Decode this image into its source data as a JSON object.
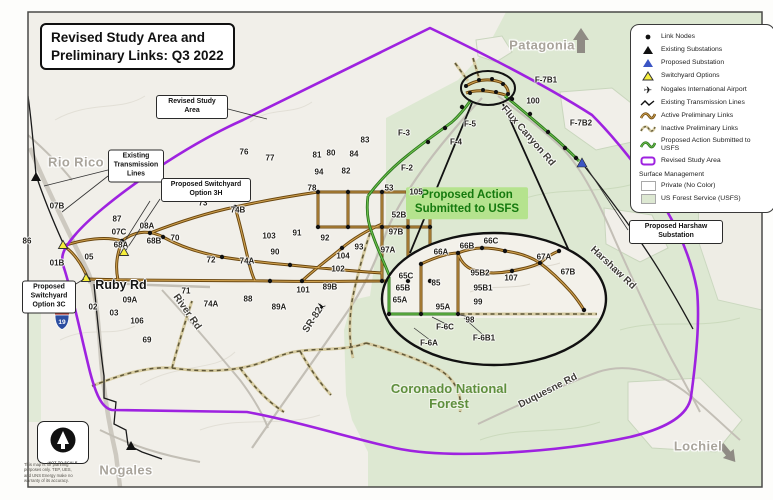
{
  "title": {
    "line1": "Revised Study Area and",
    "line2": "Preliminary Links: Q3 2022"
  },
  "legend": {
    "items": [
      {
        "icon": "link-node",
        "label": "Link Nodes"
      },
      {
        "icon": "existing-substation",
        "label": "Existing Substations"
      },
      {
        "icon": "proposed-substation",
        "label": "Proposed Substation"
      },
      {
        "icon": "switchyard-option",
        "label": "Switchyard Options"
      },
      {
        "icon": "airport",
        "label": "Nogales International Airport"
      },
      {
        "icon": "existing-transmission",
        "label": "Existing Transmission Lines"
      },
      {
        "icon": "active-link",
        "label": "Active Preliminary Links"
      },
      {
        "icon": "inactive-link",
        "label": "Inactive Preliminary Links"
      },
      {
        "icon": "proposed-action",
        "label": "Proposed Action Submitted to USFS"
      },
      {
        "icon": "study-area",
        "label": "Revised Study Area"
      }
    ],
    "surface_header": "Surface Management",
    "surface_items": [
      {
        "icon": "swatch-private",
        "label": "Private (No Color)"
      },
      {
        "icon": "swatch-usfs",
        "label": "US Forest Service (USFS)"
      }
    ]
  },
  "callouts": {
    "revised_study_area": "Revised Study Area",
    "existing_transmission": "Existing Transmission Lines",
    "switchyard_3h": "Proposed Switchyard Option 3H",
    "switchyard_3c": "Proposed Switchyard Option 3C",
    "harshaw_substation": "Proposed Harshaw Substation"
  },
  "proposed_action_label": "Proposed Action Submitted to USFS",
  "north": {
    "caption": "NOT TO SCALE"
  },
  "disclaimer": "This map is for planning purposes only. TEP, UES, and UNS Energy make no warranty of its accuracy.",
  "interstate_shield": "19",
  "places": [
    {
      "text": "Patagonia",
      "x": 542,
      "y": 45,
      "cls": "place-city"
    },
    {
      "text": "Rio Rico",
      "x": 76,
      "y": 162,
      "cls": "place-city"
    },
    {
      "text": "Nogales",
      "x": 126,
      "y": 470,
      "cls": "place-city"
    },
    {
      "text": "Lochiel",
      "x": 698,
      "y": 446,
      "cls": "place-city"
    },
    {
      "text": "Coronado National Forest",
      "x": 449,
      "y": 397,
      "cls": "place-forest"
    }
  ],
  "roads": [
    {
      "text": "Ruby Rd",
      "x": 121,
      "y": 285,
      "rot": 0,
      "cls": "road-major"
    },
    {
      "text": "River Rd",
      "x": 187,
      "y": 312,
      "rot": 55
    },
    {
      "text": "SR-82",
      "x": 313,
      "y": 320,
      "rot": -57
    },
    {
      "text": "Flux Canyon Rd",
      "x": 528,
      "y": 136,
      "rot": 49
    },
    {
      "text": "Harshaw Rd",
      "x": 613,
      "y": 268,
      "rot": 43
    },
    {
      "text": "Duquesne Rd",
      "x": 548,
      "y": 391,
      "rot": -27
    }
  ],
  "links": [
    {
      "text": "07B",
      "x": 57,
      "y": 206
    },
    {
      "text": "86",
      "x": 27,
      "y": 241
    },
    {
      "text": "87",
      "x": 117,
      "y": 219
    },
    {
      "text": "07C",
      "x": 119,
      "y": 232
    },
    {
      "text": "68A",
      "x": 121,
      "y": 245
    },
    {
      "text": "08A",
      "x": 147,
      "y": 226
    },
    {
      "text": "68B",
      "x": 154,
      "y": 241
    },
    {
      "text": "70",
      "x": 175,
      "y": 238
    },
    {
      "text": "01B",
      "x": 57,
      "y": 263
    },
    {
      "text": "05",
      "x": 89,
      "y": 257
    },
    {
      "text": "02",
      "x": 93,
      "y": 307
    },
    {
      "text": "03",
      "x": 114,
      "y": 313
    },
    {
      "text": "09A",
      "x": 130,
      "y": 300
    },
    {
      "text": "106",
      "x": 137,
      "y": 321
    },
    {
      "text": "69",
      "x": 147,
      "y": 340
    },
    {
      "text": "71",
      "x": 186,
      "y": 291
    },
    {
      "text": "72",
      "x": 211,
      "y": 260
    },
    {
      "text": "73",
      "x": 203,
      "y": 203
    },
    {
      "text": "74B",
      "x": 238,
      "y": 210
    },
    {
      "text": "74A",
      "x": 247,
      "y": 261
    },
    {
      "text": "74A",
      "x": 211,
      "y": 304
    },
    {
      "text": "88",
      "x": 248,
      "y": 299
    },
    {
      "text": "89A",
      "x": 279,
      "y": 307
    },
    {
      "text": "101",
      "x": 303,
      "y": 290
    },
    {
      "text": "89B",
      "x": 330,
      "y": 287
    },
    {
      "text": "102",
      "x": 338,
      "y": 269
    },
    {
      "text": "104",
      "x": 343,
      "y": 256
    },
    {
      "text": "103",
      "x": 269,
      "y": 236
    },
    {
      "text": "90",
      "x": 275,
      "y": 252
    },
    {
      "text": "91",
      "x": 297,
      "y": 233
    },
    {
      "text": "92",
      "x": 325,
      "y": 238
    },
    {
      "text": "93",
      "x": 359,
      "y": 247
    },
    {
      "text": "76",
      "x": 244,
      "y": 152
    },
    {
      "text": "77",
      "x": 270,
      "y": 158
    },
    {
      "text": "78",
      "x": 312,
      "y": 188
    },
    {
      "text": "94",
      "x": 319,
      "y": 172
    },
    {
      "text": "82",
      "x": 346,
      "y": 171
    },
    {
      "text": "81",
      "x": 317,
      "y": 155
    },
    {
      "text": "80",
      "x": 331,
      "y": 153
    },
    {
      "text": "84",
      "x": 354,
      "y": 154
    },
    {
      "text": "83",
      "x": 365,
      "y": 140
    },
    {
      "text": "F-3",
      "x": 404,
      "y": 133
    },
    {
      "text": "F-2",
      "x": 407,
      "y": 168
    },
    {
      "text": "F-4",
      "x": 456,
      "y": 142
    },
    {
      "text": "F-5",
      "x": 470,
      "y": 124
    },
    {
      "text": "53",
      "x": 389,
      "y": 188
    },
    {
      "text": "105",
      "x": 416,
      "y": 192
    },
    {
      "text": "52B",
      "x": 399,
      "y": 215
    },
    {
      "text": "97B",
      "x": 396,
      "y": 232
    },
    {
      "text": "97A",
      "x": 388,
      "y": 250
    },
    {
      "text": "F-7B1",
      "x": 546,
      "y": 80
    },
    {
      "text": "100",
      "x": 533,
      "y": 101
    },
    {
      "text": "F-7B2",
      "x": 581,
      "y": 123
    },
    {
      "text": "66A",
      "x": 441,
      "y": 252
    },
    {
      "text": "66B",
      "x": 467,
      "y": 246
    },
    {
      "text": "66C",
      "x": 491,
      "y": 241
    },
    {
      "text": "67A",
      "x": 544,
      "y": 257
    },
    {
      "text": "65C",
      "x": 406,
      "y": 276
    },
    {
      "text": "65B",
      "x": 403,
      "y": 288
    },
    {
      "text": "65A",
      "x": 400,
      "y": 300
    },
    {
      "text": "85",
      "x": 436,
      "y": 283
    },
    {
      "text": "95B2",
      "x": 480,
      "y": 273
    },
    {
      "text": "95B1",
      "x": 483,
      "y": 288
    },
    {
      "text": "107",
      "x": 511,
      "y": 278
    },
    {
      "text": "67B",
      "x": 568,
      "y": 272
    },
    {
      "text": "99",
      "x": 478,
      "y": 302
    },
    {
      "text": "95A",
      "x": 443,
      "y": 307
    },
    {
      "text": "98",
      "x": 470,
      "y": 320
    },
    {
      "text": "F-6C",
      "x": 445,
      "y": 327
    },
    {
      "text": "F-6A",
      "x": 429,
      "y": 343
    },
    {
      "text": "F-6B1",
      "x": 484,
      "y": 338
    }
  ],
  "colors": {
    "study_area_purple": "#9e22e0",
    "active_link_brown": "#6b470f",
    "inactive_link_tan": "#d6cba1",
    "proposed_action_green": "#2f8f22",
    "usfs_green": "#dde8d2",
    "proposed_substation_blue": "#3b55c4",
    "switchyard_yellow": "#f6ee3c"
  }
}
